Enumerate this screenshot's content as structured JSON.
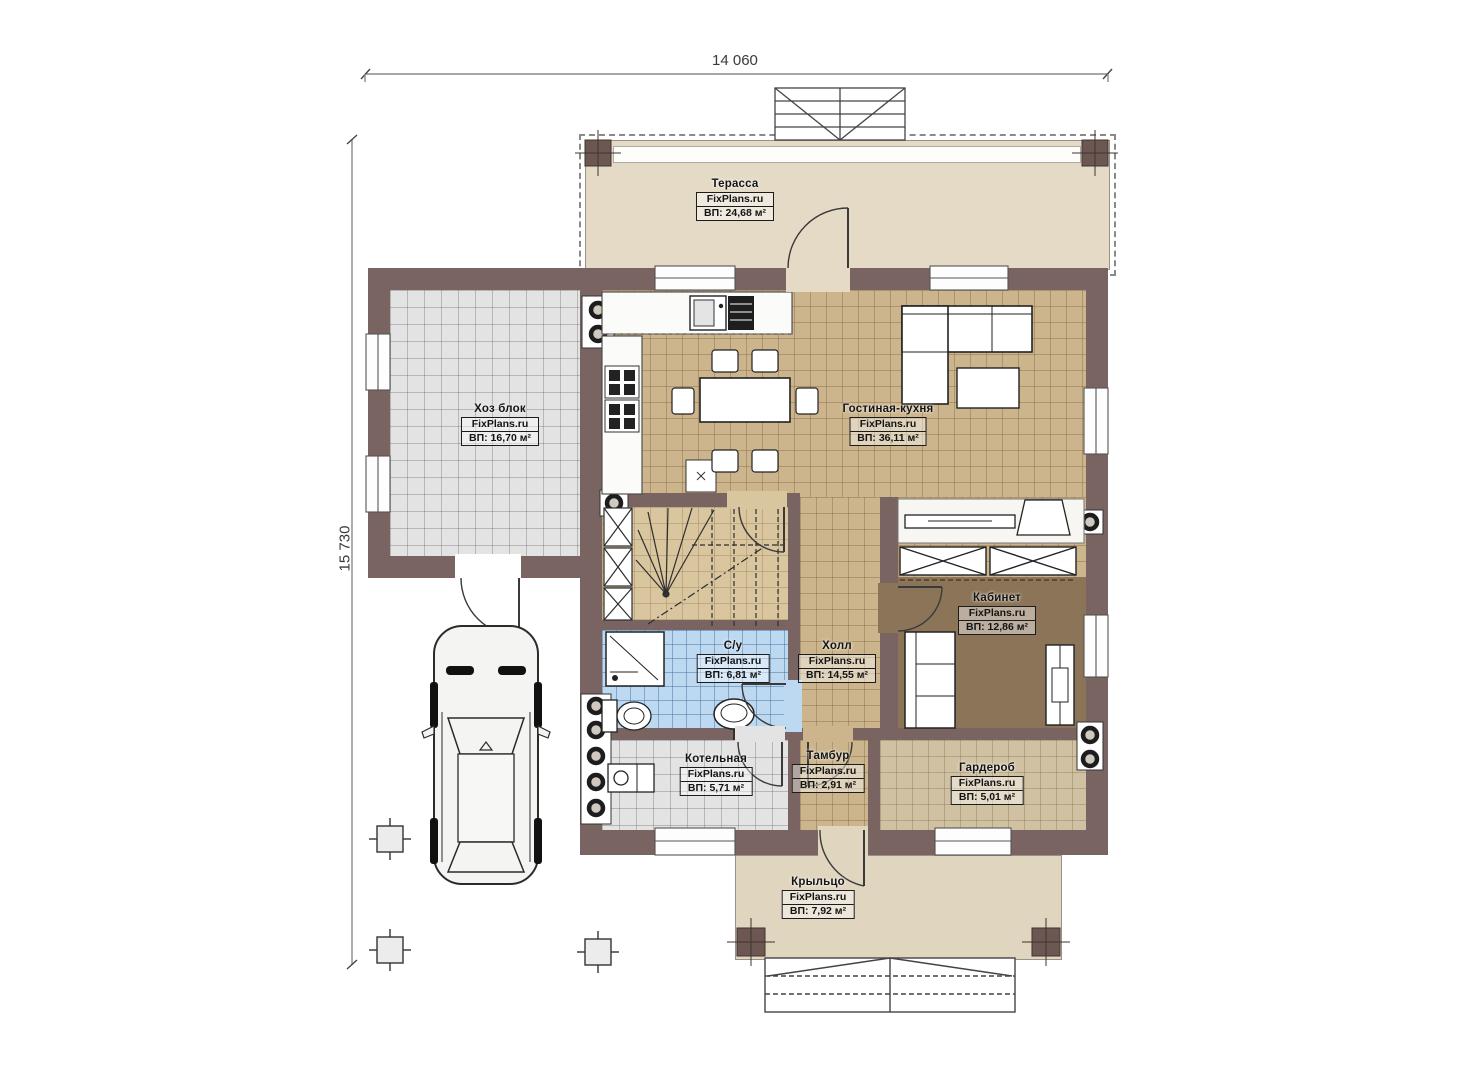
{
  "plan": {
    "brand": "FixPlans.ru",
    "dimensions": {
      "width": "14 060",
      "height": "15 730"
    },
    "rooms": [
      {
        "name": "Терасса",
        "area": "ВП: 24,68 м²"
      },
      {
        "name": "Хоз блок",
        "area": "ВП: 16,70 м²"
      },
      {
        "name": "Гостиная-кухня",
        "area": "ВП: 36,11 м²"
      },
      {
        "name": "Кабинет",
        "area": "ВП: 12,86 м²"
      },
      {
        "name": "Холл",
        "area": "ВП: 14,55 м²"
      },
      {
        "name": "С/у",
        "area": "ВП: 6,81 м²"
      },
      {
        "name": "Котельная",
        "area": "ВП: 5,71 м²"
      },
      {
        "name": "Тамбур",
        "area": "ВП: 2,91 м²"
      },
      {
        "name": "Гардероб",
        "area": "ВП: 5,01 м²"
      },
      {
        "name": "Крыльцо",
        "area": "ВП: 7,92 м²"
      }
    ],
    "colors": {
      "wall": "#796461",
      "terrace_floor": "#e4dac6",
      "porch_floor": "#e0d5bf",
      "living_tile": "#ccb58c",
      "utility_tile": "#e3e3e3",
      "bath_tile": "#bdd9f1",
      "cabinet_floor": "#8b7458"
    }
  }
}
